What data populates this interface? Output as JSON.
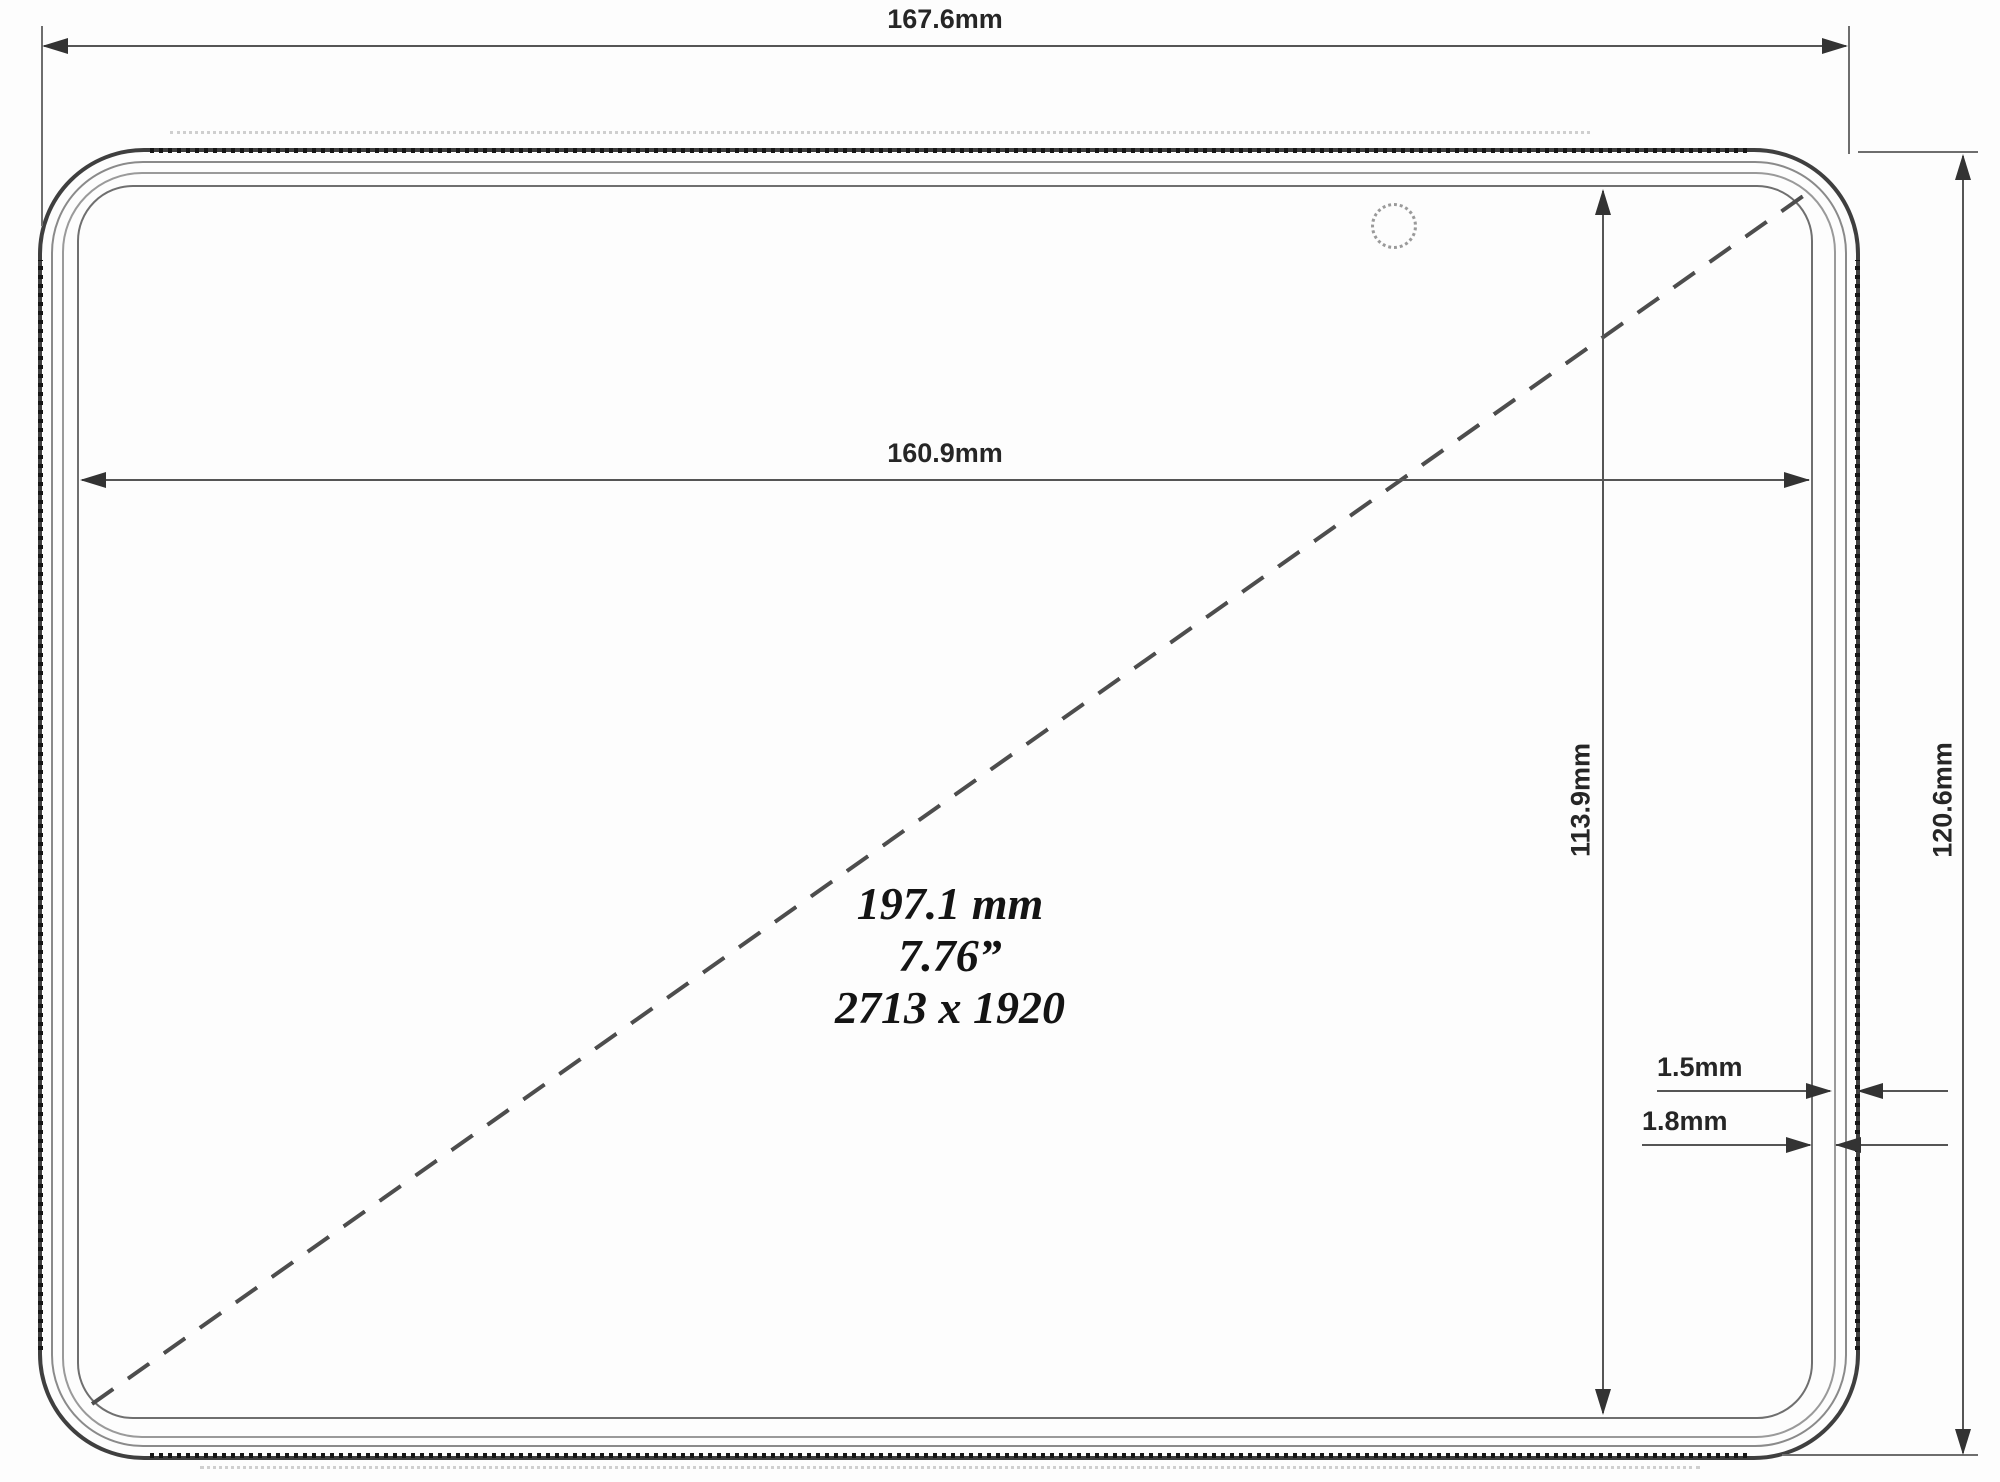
{
  "colors": {
    "background": "#fdfdfd",
    "dimension_line": "#555555",
    "device_edge_dark": "#3f3f3f",
    "text": "#262626"
  },
  "labels": {
    "overall_width": "167.6mm",
    "display_width": "160.9mm",
    "display_height": "113.9mm",
    "overall_height": "120.6mm",
    "wall_thickness": "1.5mm",
    "bezel_gap": "1.8mm"
  },
  "center_annotation": {
    "diagonal_mm": "197.1 mm",
    "diagonal_inches": "7.76”",
    "resolution": "2713 x 1920"
  }
}
